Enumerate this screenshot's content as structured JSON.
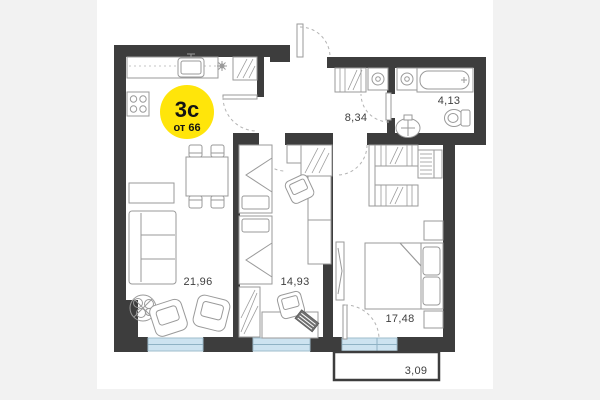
{
  "page": {
    "background": "#f2f2f2",
    "card_background": "#ffffff"
  },
  "badge": {
    "rooms_label": "3с",
    "price_from_label": "от 66",
    "fill": "#ffe50a",
    "text_color": "#141414"
  },
  "rooms": [
    {
      "name": "kitchen-living-room",
      "area_label": "21,96"
    },
    {
      "name": "bedroom-middle",
      "area_label": "14,93"
    },
    {
      "name": "hallway",
      "area_label": "8,34"
    },
    {
      "name": "bathroom",
      "area_label": "4,13"
    },
    {
      "name": "bedroom-master",
      "area_label": "17,48"
    },
    {
      "name": "balcony",
      "area_label": "3,09"
    }
  ],
  "colors": {
    "wall": "#3d3d3d",
    "furniture_line": "#9a9a9a",
    "window_fill": "#cde3f0",
    "window_border": "#9fbccb",
    "door_arc": "#b3b3b3",
    "label_text": "#3f3f3f"
  }
}
